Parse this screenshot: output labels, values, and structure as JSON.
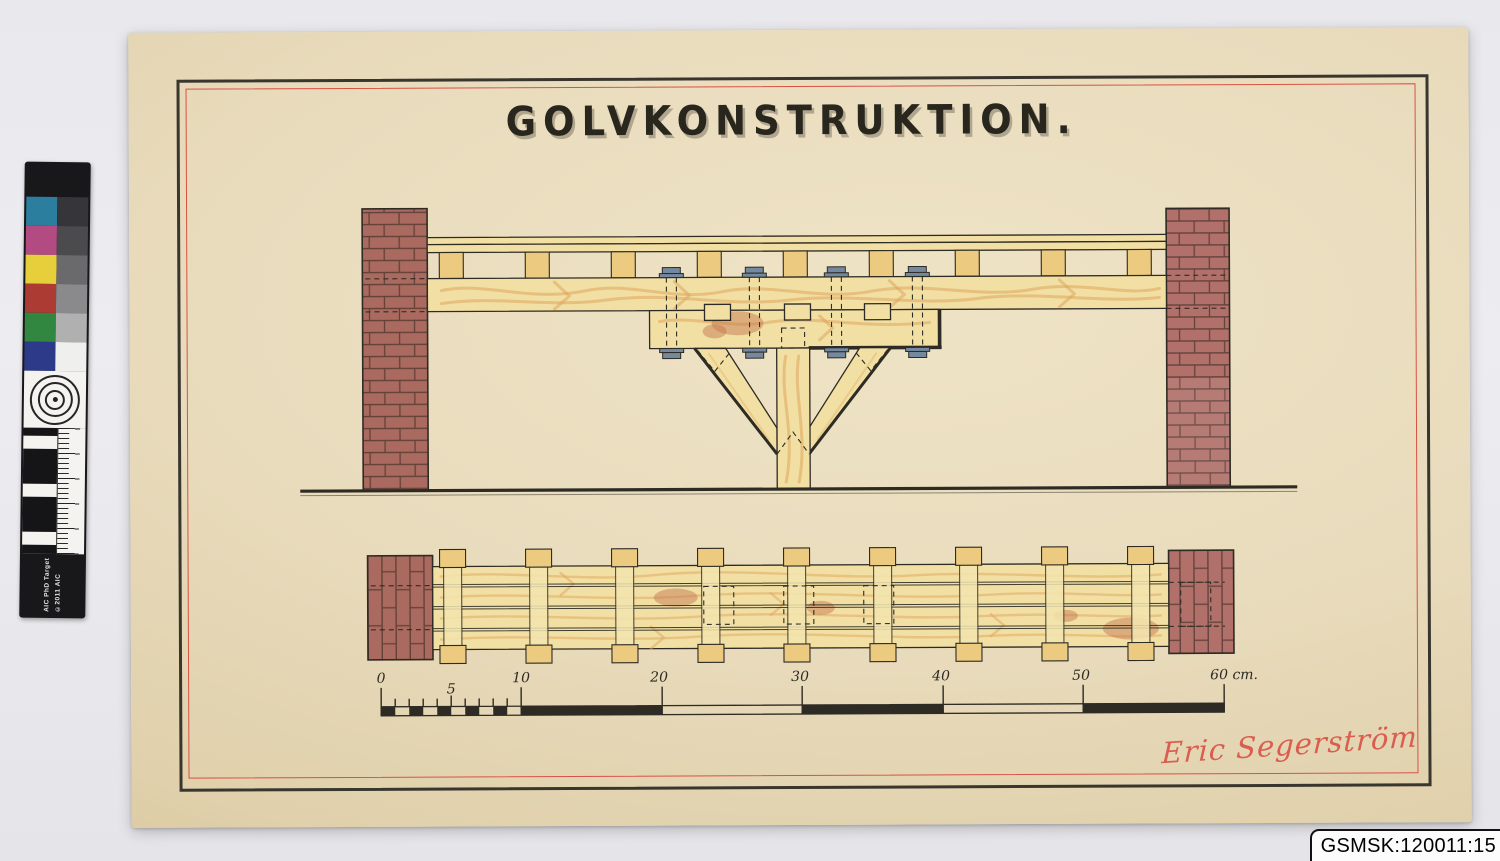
{
  "photo": {
    "catalog_label": "GSMSK:120011:15"
  },
  "drawing": {
    "title": "GOLVKONSTRUKTION.",
    "signature": "Eric Segerström",
    "scale_bar": {
      "unit": "cm",
      "tick_labels": [
        "0",
        "5",
        "10",
        "20",
        "30",
        "40",
        "50",
        "60 cm."
      ]
    }
  },
  "color_target": {
    "label_line1": "AIC PhD Target",
    "label_line2": "©2011 AIC",
    "patches": [
      "#2b7e9d",
      "#b14b82",
      "#e6cf3a",
      "#ab3b33",
      "#31873f",
      "#2d3a8a"
    ],
    "grays": [
      "#35353a",
      "#4b4b4e",
      "#6a6a6d",
      "#8a8a8c",
      "#b0b0b0",
      "#efefed"
    ]
  },
  "colors": {
    "bg": "#eaeaee",
    "paper": "#e9dcbf",
    "ink": "#2e2b24",
    "border_red": "#d85243",
    "brick": "#aa6a5f",
    "brick2": "#b1706a",
    "mortar": "#4a332b",
    "wood_light": "#f1dfa4",
    "wood_mid": "#eccb80",
    "wood_grain": "#dfa65c",
    "bolt_blue": "#74889f",
    "stain": "#c4714b",
    "signature_red": "#d95448"
  }
}
